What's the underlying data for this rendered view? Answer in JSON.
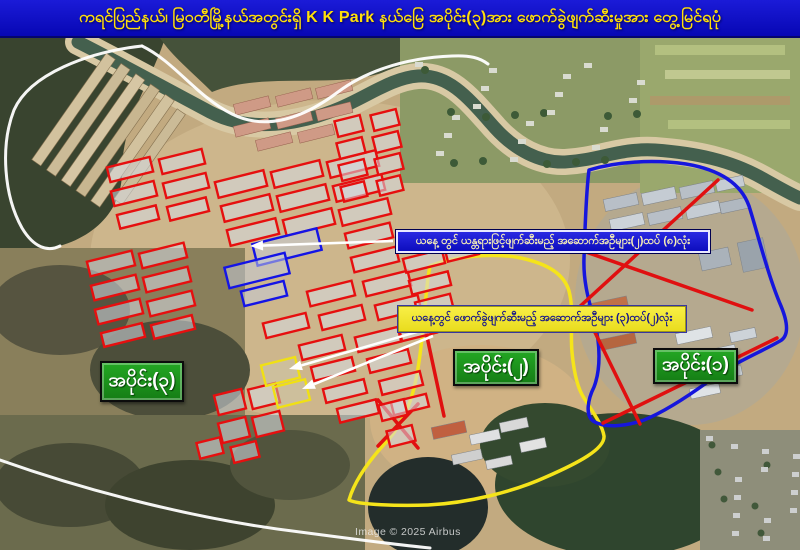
{
  "title_bar": {
    "text": "ကရင်ပြည်နယ်၊ မြဝတီမြို့နယ်အတွင်းရှိ  K K Park နယ်မြေ အပိုင်း(၃)အား ဖောက်ခွဲဖျက်ဆီးမှုအား တွေ့မြင်ရပုံ",
    "bg": "#0b0bcf",
    "fg": "#ffdf0a"
  },
  "banners": {
    "blue": {
      "text": "ယနေ့ တွင် ယန္တရားဖြင့်ဖျက်ဆီးမည့် အဆောက်အဦများ(၂)ထပ်  (၈)လုံး",
      "bg": "#1414cc",
      "fg": "#f6eeb6"
    },
    "yellow": {
      "text": "ယနေ့တွင် ဖောက်ခွဲဖျက်ဆီးမည့် အဆောက်အဦများ (၃)ထပ်(၂)လုံး",
      "bg": "#f2e836",
      "fg": "#14148c"
    }
  },
  "section_labels": [
    {
      "id": "section-3",
      "text": "အပိုင်း(၃)"
    },
    {
      "id": "section-2",
      "text": "အပိုင်း(၂)"
    },
    {
      "id": "section-1",
      "text": "အပိုင်း(၁)"
    }
  ],
  "credit": "Image © 2025 Airbus",
  "colors": {
    "marked_red": "#e60f0f",
    "marked_blue": "#1414e6",
    "marked_yellow": "#f0e014",
    "boundary_yellow": "#f5e41a",
    "boundary_blue": "#1616dd",
    "cross_red": "#e01010",
    "road_white": "#ffffff"
  },
  "overlays": {
    "red_buildings": [
      [
        88,
        256,
        46,
        15
      ],
      [
        140,
        248,
        46,
        15
      ],
      [
        92,
        280,
        46,
        15
      ],
      [
        144,
        272,
        46,
        15
      ],
      [
        96,
        304,
        46,
        15
      ],
      [
        148,
        296,
        46,
        15
      ],
      [
        102,
        328,
        42,
        14
      ],
      [
        152,
        320,
        42,
        14
      ],
      [
        108,
        162,
        44,
        15
      ],
      [
        160,
        154,
        44,
        15
      ],
      [
        112,
        186,
        44,
        15
      ],
      [
        164,
        178,
        44,
        15
      ],
      [
        118,
        210,
        40,
        14
      ],
      [
        168,
        202,
        40,
        14
      ],
      [
        216,
        176,
        50,
        16
      ],
      [
        272,
        166,
        50,
        16
      ],
      [
        328,
        156,
        50,
        16
      ],
      [
        222,
        200,
        50,
        16
      ],
      [
        278,
        190,
        50,
        16
      ],
      [
        334,
        180,
        50,
        16
      ],
      [
        228,
        224,
        50,
        16
      ],
      [
        284,
        214,
        50,
        16
      ],
      [
        340,
        204,
        50,
        16
      ],
      [
        346,
        228,
        46,
        15
      ],
      [
        352,
        252,
        46,
        15
      ],
      [
        308,
        286,
        46,
        15
      ],
      [
        364,
        276,
        46,
        15
      ],
      [
        264,
        318,
        44,
        15
      ],
      [
        320,
        310,
        44,
        15
      ],
      [
        376,
        300,
        44,
        15
      ],
      [
        300,
        340,
        44,
        15
      ],
      [
        356,
        332,
        44,
        15
      ],
      [
        400,
        324,
        36,
        13
      ],
      [
        312,
        362,
        42,
        14
      ],
      [
        368,
        354,
        42,
        14
      ],
      [
        324,
        384,
        42,
        14
      ],
      [
        380,
        376,
        42,
        14
      ],
      [
        338,
        404,
        40,
        14
      ],
      [
        392,
        398,
        36,
        13
      ],
      [
        336,
        118,
        26,
        16
      ],
      [
        338,
        140,
        26,
        16
      ],
      [
        340,
        162,
        26,
        16
      ],
      [
        342,
        184,
        24,
        15
      ],
      [
        372,
        112,
        26,
        16
      ],
      [
        374,
        134,
        26,
        16
      ],
      [
        376,
        156,
        26,
        16
      ],
      [
        378,
        178,
        24,
        15
      ],
      [
        404,
        254,
        40,
        14
      ],
      [
        410,
        276,
        40,
        14
      ],
      [
        416,
        298,
        36,
        13
      ],
      [
        446,
        246,
        32,
        12
      ],
      [
        216,
        392,
        28,
        20
      ],
      [
        250,
        386,
        28,
        20
      ],
      [
        220,
        420,
        28,
        20
      ],
      [
        254,
        414,
        28,
        20
      ],
      [
        198,
        440,
        24,
        16
      ],
      [
        232,
        444,
        26,
        16
      ],
      [
        380,
        402,
        26,
        16
      ],
      [
        388,
        428,
        26,
        16
      ]
    ],
    "blue_buildings": [
      [
        254,
        236,
        66,
        22
      ],
      [
        226,
        260,
        62,
        21
      ],
      [
        242,
        286,
        44,
        15
      ]
    ],
    "yellow_buildings": [
      [
        263,
        361,
        35,
        21
      ],
      [
        275,
        383,
        33,
        21
      ]
    ],
    "building_rotation": -14,
    "boundary_yellow_path": "M430,266 C452,257 492,252 521,258 C548,264 564,274 569,291 C574,310 570,331 572,352 C574,374 578,389 584,398 C592,411 602,424 604,436 C605,449 578,463 546,477 C513,492 468,503 428,505 C400,506 358,505 349,500 C355,479 372,457 389,439 C400,426 409,407 413,392 C418,374 421,349 424,319 C426,294 428,275 430,266 Z",
    "boundary_blue_path": "M589,170 C615,162 652,159 686,164 C716,169 740,181 749,206 C757,231 768,276 781,306 C788,323 789,336 780,341 C759,353 733,363 709,381 C687,397 664,412 644,420 C624,427 604,428 593,421 C585,415 588,399 594,387 C601,369 600,344 595,324 C590,304 583,284 584,258 C585,228 586,193 589,170 Z",
    "red_cross_lines": [
      [
        718,
        180,
        576,
        310
      ],
      [
        586,
        252,
        752,
        310
      ],
      [
        582,
        306,
        640,
        424
      ],
      [
        777,
        338,
        603,
        423
      ],
      [
        426,
        332,
        444,
        416
      ],
      [
        378,
        400,
        418,
        448
      ],
      [
        418,
        404,
        378,
        446
      ]
    ],
    "white_roads": [
      "M142,46 C88,52 30,74 14,110 C0,146 4,196 22,228 C34,248 48,252 60,246",
      "M142,46 C175,62 196,96 232,114 C268,132 306,116 338,92 C362,74 400,58 452,56 C470,55 480,58 488,64",
      "M0,460 C90,492 200,520 300,532 C345,538 390,544 430,548"
    ],
    "white_arrows": [
      {
        "from": [
          393,
          241
        ],
        "to": [
          250,
          246
        ]
      },
      {
        "from": [
          427,
          329
        ],
        "to": [
          289,
          369
        ]
      },
      {
        "from": [
          433,
          336
        ],
        "to": [
          302,
          389
        ]
      }
    ]
  }
}
